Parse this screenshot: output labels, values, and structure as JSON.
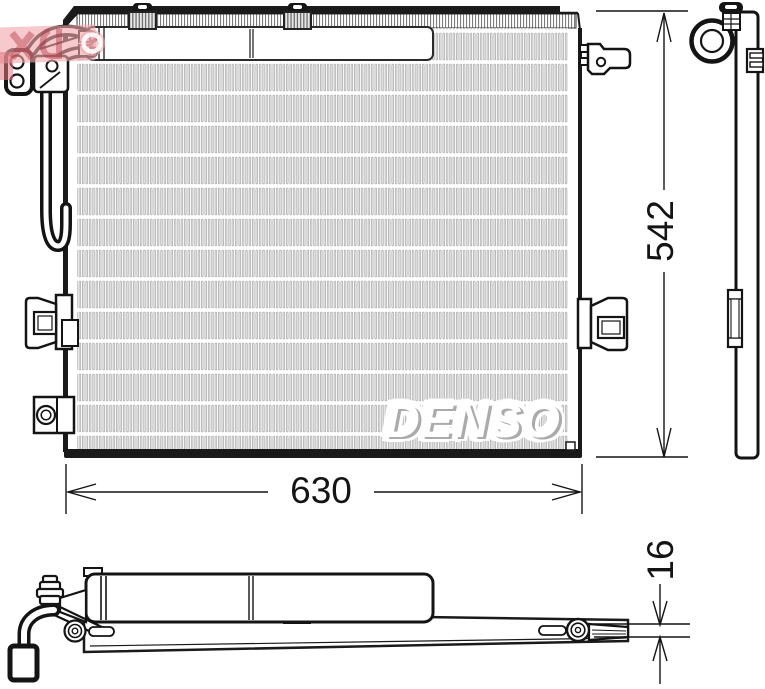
{
  "drawing": {
    "brand_logo": "DENSO",
    "dimensions": {
      "width": "630",
      "height": "542",
      "depth": "16"
    },
    "colors": {
      "line": "#1a1a1a",
      "fins": "#8a8a8a",
      "watermark_pink": "#f2a6ad",
      "background": "#ffffff"
    }
  }
}
